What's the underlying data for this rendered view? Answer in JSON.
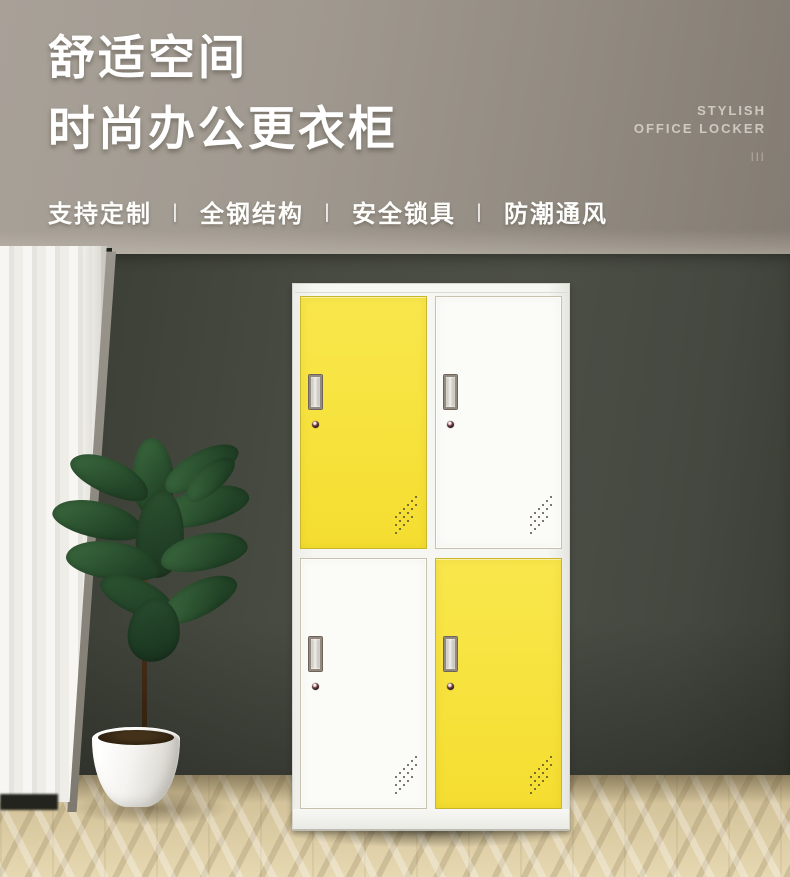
{
  "banner": {
    "title_line1": "舒适空间",
    "title_line2": "时尚办公更衣柜",
    "features": [
      "支持定制",
      "全钢结构",
      "安全锁具",
      "防潮通风"
    ],
    "separator": "丨",
    "tagline_line1": "STYLISH",
    "tagline_line2": "OFFICE LOCKER",
    "tagline_marks": "|||"
  },
  "scene": {
    "locker": {
      "doors": [
        {
          "position": "top-left",
          "color": "yellow"
        },
        {
          "position": "top-right",
          "color": "white"
        },
        {
          "position": "bottom-left",
          "color": "white"
        },
        {
          "position": "bottom-right",
          "color": "yellow"
        }
      ]
    },
    "colors": {
      "accent_yellow": "#f6e03a",
      "door_white": "#fbfbf8",
      "wall_dark": "#464840",
      "wall_header_light": "#a8a198",
      "wall_header_dark": "#837c73",
      "floor_wood": "#dbcaa4",
      "curtain_white": "#f3f2ed",
      "text_white": "#ffffff"
    }
  }
}
